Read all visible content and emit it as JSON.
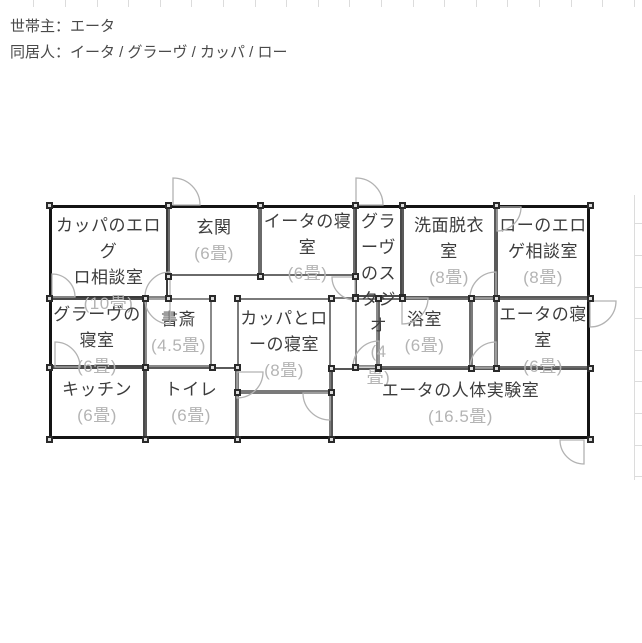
{
  "header": {
    "line1": "世帯主：エータ",
    "line2": "同居人：イータ / グラーヴ / カッパ / ロー"
  },
  "floorplan": {
    "outer": {
      "x": 49,
      "y": 205,
      "w": 541,
      "h": 234
    },
    "rooms": [
      {
        "id": "kappa-eroguro-soudan",
        "nameLines": [
          "カッパのエログ",
          "ロ相談室"
        ],
        "sizeLines": [
          "(10畳)"
        ],
        "x": 49,
        "y": 205,
        "w": 119,
        "h": 93,
        "stroke": "#3a3a3a"
      },
      {
        "id": "genkan",
        "nameLines": [
          "玄関"
        ],
        "sizeLines": [
          "(6畳)"
        ],
        "x": 168,
        "y": 205,
        "w": 92,
        "h": 71,
        "stroke": "#6a6a6a"
      },
      {
        "id": "iita-bedroom",
        "nameLines": [
          "イータの寝",
          "室"
        ],
        "sizeLines": [
          "(6畳)"
        ],
        "x": 260,
        "y": 205,
        "w": 95,
        "h": 71,
        "stroke": "#6a6a6a"
      },
      {
        "id": "grave-studio",
        "nameLines": [
          "グラ",
          "ーヴ",
          "のス",
          "タジ",
          "オ"
        ],
        "sizeLines": [
          "(4",
          "畳)"
        ],
        "x": 355,
        "y": 205,
        "w": 47,
        "h": 92,
        "stroke": "#4a4a4a"
      },
      {
        "id": "senmen-datsui",
        "nameLines": [
          "洗面脱衣",
          "室"
        ],
        "sizeLines": [
          "(8畳)"
        ],
        "x": 402,
        "y": 205,
        "w": 94,
        "h": 93,
        "stroke": "#5a5a5a"
      },
      {
        "id": "ro-eroge-soudan",
        "nameLines": [
          "ローのエロ",
          "ゲ相談室"
        ],
        "sizeLines": [
          "(8畳)"
        ],
        "x": 496,
        "y": 205,
        "w": 94,
        "h": 93,
        "stroke": "#5a5a5a"
      },
      {
        "id": "grave-bedroom",
        "nameLines": [
          "グラーヴの",
          "寝室"
        ],
        "sizeLines": [
          "(6畳)"
        ],
        "x": 49,
        "y": 298,
        "w": 96,
        "h": 69,
        "stroke": "#4a4a4a"
      },
      {
        "id": "shosai",
        "nameLines": [
          "書斎"
        ],
        "sizeLines": [
          "(4.5畳)"
        ],
        "x": 145,
        "y": 298,
        "w": 67,
        "h": 69,
        "stroke": "#8a8a8a"
      },
      {
        "id": "kappa-ro-bedroom",
        "nameLines": [
          "カッパとロ",
          "ーの寝室"
        ],
        "sizeLines": [
          "(8畳)"
        ],
        "x": 237,
        "y": 298,
        "w": 94,
        "h": 94,
        "stroke": "#7a7a7a"
      },
      {
        "id": "yokushitsu",
        "nameLines": [
          "浴室"
        ],
        "sizeLines": [
          "(6畳)"
        ],
        "x": 378,
        "y": 298,
        "w": 93,
        "h": 70,
        "stroke": "#6a6a6a"
      },
      {
        "id": "eta-bedroom",
        "nameLines": [
          "エータの寝",
          "室"
        ],
        "sizeLines": [
          "(6畳)"
        ],
        "x": 496,
        "y": 298,
        "w": 94,
        "h": 70,
        "stroke": "#6a6a6a"
      },
      {
        "id": "kitchen",
        "nameLines": [
          "キッチン"
        ],
        "sizeLines": [
          "(6畳)"
        ],
        "x": 49,
        "y": 367,
        "w": 96,
        "h": 72,
        "stroke": "#4a4a4a"
      },
      {
        "id": "toilet",
        "nameLines": [
          "トイレ"
        ],
        "sizeLines": [
          "(6畳)"
        ],
        "x": 145,
        "y": 367,
        "w": 92,
        "h": 72,
        "stroke": "#5a5a5a"
      },
      {
        "id": "eta-jintai-jikken",
        "nameLines": [
          "エータの人体実験室"
        ],
        "sizeLines": [
          "(16.5畳)"
        ],
        "x": 331,
        "y": 368,
        "w": 259,
        "h": 71,
        "stroke": "#555555"
      },
      {
        "id": "eta-jintai-jikken-notch",
        "nameLines": [],
        "sizeLines": [],
        "x": 237,
        "y": 392,
        "w": 94,
        "h": 47,
        "stroke": "#7a7a7a"
      },
      {
        "id": "corridor-a",
        "nameLines": [],
        "sizeLines": [],
        "x": 355,
        "y": 298,
        "w": 23,
        "h": 69,
        "stroke": "#8a8a8a"
      },
      {
        "id": "corridor-b",
        "nameLines": [],
        "sizeLines": [],
        "x": 471,
        "y": 298,
        "w": 25,
        "h": 70,
        "stroke": "#7a7a7a"
      }
    ],
    "walls": [
      {
        "x": 331,
        "y": 297,
        "w": 24
      }
    ],
    "doors": [
      {
        "x": 173,
        "y": 205,
        "quad": "ne",
        "r": 27
      },
      {
        "x": 356,
        "y": 205,
        "quad": "ne",
        "r": 27
      },
      {
        "x": 52,
        "y": 297,
        "quad": "ne",
        "r": 23
      },
      {
        "x": 170,
        "y": 297,
        "quad": "nw",
        "r": 25
      },
      {
        "x": 170,
        "y": 299,
        "quad": "sw",
        "r": 25
      },
      {
        "x": 355,
        "y": 277,
        "quad": "sw",
        "r": 23
      },
      {
        "x": 496,
        "y": 298,
        "quad": "nw",
        "r": 26
      },
      {
        "x": 497,
        "y": 207,
        "quad": "se",
        "r": 24
      },
      {
        "x": 590,
        "y": 301,
        "quad": "se",
        "r": 26
      },
      {
        "x": 584,
        "y": 440,
        "quad": "sw",
        "r": 24
      },
      {
        "x": 237,
        "y": 372,
        "quad": "se",
        "r": 26
      },
      {
        "x": 330,
        "y": 393,
        "quad": "sw",
        "r": 27
      },
      {
        "x": 55,
        "y": 367,
        "quad": "ne",
        "r": 25
      },
      {
        "x": 402,
        "y": 298,
        "quad": "se",
        "r": 26
      },
      {
        "x": 496,
        "y": 368,
        "quad": "nw",
        "r": 26
      },
      {
        "x": 379,
        "y": 367,
        "quad": "nw",
        "r": 26
      }
    ],
    "colors": {
      "outer_wall": "#141414",
      "door": "#b2b2b2",
      "room_name": "#3c3c3c",
      "room_size": "#b4b4b4",
      "handle_border": "#2a2a2a",
      "handle_fill": "#dcdcdc",
      "grid": "#dcdcdc"
    }
  }
}
